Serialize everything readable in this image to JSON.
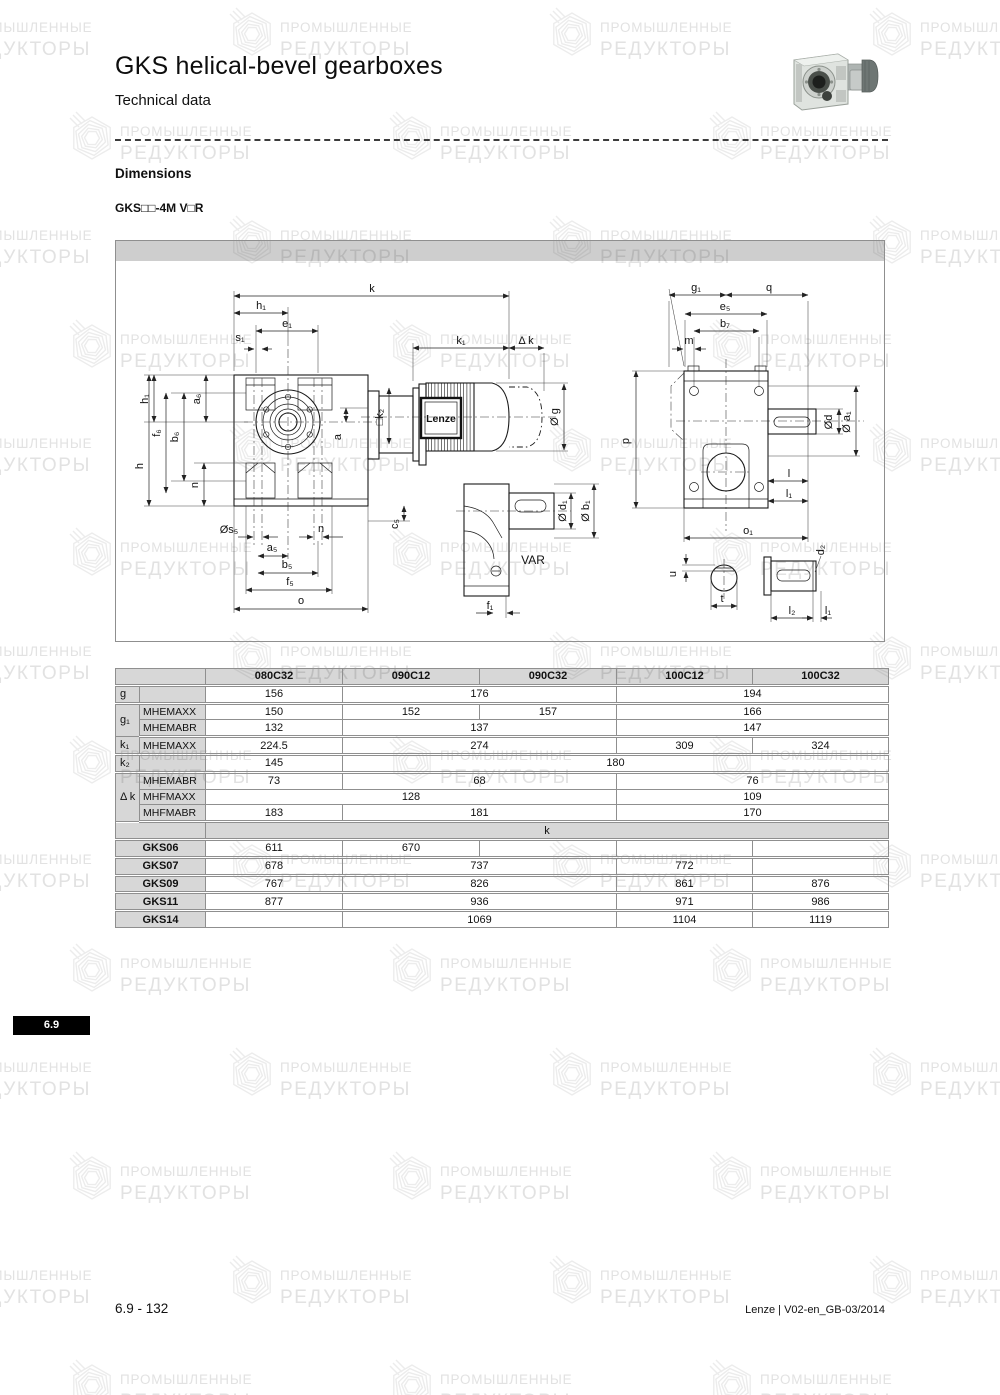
{
  "page": {
    "title": "GKS helical-bevel gearboxes",
    "subtitle": "Technical data",
    "section_heading": "Dimensions",
    "model_code": "GKS□□-4M V□R",
    "side_tab": "6.9",
    "footer_left": "6.9 - 132",
    "footer_right": "Lenze | V02-en_GB-03/2014"
  },
  "watermark": {
    "line1": "ПРОМЫШЛЕННЫЕ",
    "line2": "РЕДУКТОРЫ"
  },
  "colors": {
    "badge_bg": "#000000",
    "table_header_gray": "#d9d9d9",
    "diagram_band_gray": "#c5c5c5",
    "border_gray": "#8f8f8f",
    "watermark_gray": "#e2e2e2"
  },
  "diagram": {
    "labels": [
      {
        "t": "k",
        "x": 256,
        "y": 51
      },
      {
        "t": "h₁",
        "x": 145,
        "y": 68
      },
      {
        "t": "e₁",
        "x": 171,
        "y": 86
      },
      {
        "t": "s₁",
        "x": 124,
        "y": 100
      },
      {
        "t": "k₁",
        "x": 345,
        "y": 103
      },
      {
        "t": "Δ k",
        "x": 410,
        "y": 103
      },
      {
        "t": "□k₂",
        "x": 267,
        "y": 176,
        "r": -90
      },
      {
        "t": "a",
        "x": 225,
        "y": 196,
        "r": -90
      },
      {
        "t": "Ø g",
        "x": 442,
        "y": 176,
        "r": -90
      },
      {
        "t": "h₁",
        "x": 32,
        "y": 158,
        "r": -90
      },
      {
        "t": "a₆",
        "x": 84,
        "y": 158,
        "r": -90
      },
      {
        "t": "f₆",
        "x": 44,
        "y": 192,
        "r": -90
      },
      {
        "t": "b₆",
        "x": 62,
        "y": 196,
        "r": -90
      },
      {
        "t": "h",
        "x": 27,
        "y": 225,
        "r": -90
      },
      {
        "t": "n",
        "x": 82,
        "y": 244,
        "r": -90
      },
      {
        "t": "c₅",
        "x": 282,
        "y": 283,
        "r": -90
      },
      {
        "t": "Øs₅",
        "x": 113,
        "y": 292
      },
      {
        "t": "n",
        "x": 205,
        "y": 291
      },
      {
        "t": "a₅",
        "x": 156,
        "y": 310
      },
      {
        "t": "b₅",
        "x": 171,
        "y": 327
      },
      {
        "t": "f₅",
        "x": 174,
        "y": 344
      },
      {
        "t": "o",
        "x": 185,
        "y": 363
      },
      {
        "t": "Lenze",
        "x": 325,
        "y": 181,
        "cls": "lenze"
      },
      {
        "t": "VAR",
        "x": 417,
        "y": 323,
        "cls": "var"
      },
      {
        "t": "Ø d₁",
        "x": 450,
        "y": 270,
        "r": -90
      },
      {
        "t": "Ø b₁",
        "x": 473,
        "y": 270,
        "r": -90
      },
      {
        "t": "f₁",
        "x": 374,
        "y": 368
      },
      {
        "t": "g₁",
        "x": 580,
        "y": 50
      },
      {
        "t": "q",
        "x": 653,
        "y": 50
      },
      {
        "t": "e₅",
        "x": 609,
        "y": 69
      },
      {
        "t": "b₇",
        "x": 609,
        "y": 86
      },
      {
        "t": "m",
        "x": 573,
        "y": 103
      },
      {
        "t": "p",
        "x": 513,
        "y": 200,
        "r": -90
      },
      {
        "t": "Ød",
        "x": 716,
        "y": 181,
        "r": -90
      },
      {
        "t": "Ø a₁",
        "x": 734,
        "y": 181,
        "r": -90
      },
      {
        "t": "l",
        "x": 673,
        "y": 236
      },
      {
        "t": "l₁",
        "x": 673,
        "y": 256
      },
      {
        "t": "o₁",
        "x": 632,
        "y": 293
      },
      {
        "t": "u",
        "x": 560,
        "y": 333,
        "r": -90
      },
      {
        "t": "t",
        "x": 606,
        "y": 361
      },
      {
        "t": "d₂",
        "x": 708,
        "y": 309,
        "r": -90
      },
      {
        "t": "l₂",
        "x": 676,
        "y": 373
      },
      {
        "t": "l₁",
        "x": 712,
        "y": 373
      }
    ]
  },
  "table": {
    "rows": [
      {
        "sep": true,
        "cells": [
          {
            "t": "",
            "cs": 2,
            "cls": "hdr"
          },
          {
            "t": "080C32",
            "cls": "hdr"
          },
          {
            "t": "090C12",
            "cls": "hdr"
          },
          {
            "t": "090C32",
            "cls": "hdr"
          },
          {
            "t": "100C12",
            "cls": "hdr"
          },
          {
            "t": "100C32",
            "cls": "hdr"
          }
        ]
      },
      {
        "sep": true,
        "cells": [
          {
            "t": "g",
            "cls": "lab"
          },
          {
            "t": "",
            "cls": "sub"
          },
          {
            "t": "156",
            "cls": "val"
          },
          {
            "t": "176",
            "cs": 2,
            "cls": "val"
          },
          {
            "t": "194",
            "cs": 2,
            "cls": "val"
          }
        ]
      },
      {
        "cells": [
          {
            "t": "g₁",
            "rs": 2,
            "cls": "lab"
          },
          {
            "t": "MHEMAXX",
            "cls": "sub"
          },
          {
            "t": "150",
            "cls": "val"
          },
          {
            "t": "152",
            "cls": "val"
          },
          {
            "t": "157",
            "cls": "val"
          },
          {
            "t": "166",
            "cs": 2,
            "cls": "val"
          }
        ]
      },
      {
        "sep": true,
        "cells": [
          {
            "t": "MHEMABR",
            "cls": "sub"
          },
          {
            "t": "132",
            "cls": "val"
          },
          {
            "t": "137",
            "cs": 2,
            "cls": "val"
          },
          {
            "t": "147",
            "cs": 2,
            "cls": "val"
          }
        ]
      },
      {
        "sep": true,
        "cells": [
          {
            "t": "k₁",
            "cls": "lab"
          },
          {
            "t": "MHEMAXX",
            "cls": "sub"
          },
          {
            "t": "224.5",
            "cls": "val"
          },
          {
            "t": "274",
            "cs": 2,
            "cls": "val"
          },
          {
            "t": "309",
            "cls": "val"
          },
          {
            "t": "324",
            "cls": "val"
          }
        ]
      },
      {
        "sep": true,
        "cells": [
          {
            "t": "k₂",
            "cls": "lab"
          },
          {
            "t": "",
            "cls": "sub"
          },
          {
            "t": "145",
            "cls": "val"
          },
          {
            "t": "180",
            "cs": 4,
            "cls": "val"
          }
        ]
      },
      {
        "cells": [
          {
            "t": "Δ k",
            "rs": 3,
            "cls": "lab"
          },
          {
            "t": "MHEMABR",
            "cls": "sub"
          },
          {
            "t": "73",
            "cls": "val"
          },
          {
            "t": "68",
            "cs": 2,
            "cls": "val"
          },
          {
            "t": "76",
            "cs": 2,
            "cls": "val"
          }
        ]
      },
      {
        "cells": [
          {
            "t": "MHFMAXX",
            "cls": "sub"
          },
          {
            "t": "128",
            "cs": 3,
            "cls": "val"
          },
          {
            "t": "109",
            "cs": 2,
            "cls": "val"
          }
        ]
      },
      {
        "sep": true,
        "cells": [
          {
            "t": "MHFMABR",
            "cls": "sub"
          },
          {
            "t": "183",
            "cls": "val"
          },
          {
            "t": "181",
            "cs": 2,
            "cls": "val"
          },
          {
            "t": "170",
            "cs": 2,
            "cls": "val"
          }
        ]
      },
      {
        "sep": true,
        "cells": [
          {
            "t": "",
            "cs": 2,
            "cls": "sh"
          },
          {
            "t": "k",
            "cs": 5,
            "cls": "sh ctr"
          }
        ]
      },
      {
        "sep": true,
        "cells": [
          {
            "t": "GKS06",
            "cs": 2,
            "cls": "gks"
          },
          {
            "t": "611",
            "cls": "val"
          },
          {
            "t": "670",
            "cls": "val"
          },
          {
            "t": "",
            "cls": "val"
          },
          {
            "t": "",
            "cls": "val"
          },
          {
            "t": "",
            "cls": "val"
          }
        ]
      },
      {
        "sep": true,
        "cells": [
          {
            "t": "GKS07",
            "cs": 2,
            "cls": "gks"
          },
          {
            "t": "678",
            "cls": "val"
          },
          {
            "t": "737",
            "cs": 2,
            "cls": "val"
          },
          {
            "t": "772",
            "cls": "val"
          },
          {
            "t": "",
            "cls": "val"
          }
        ]
      },
      {
        "sep": true,
        "cells": [
          {
            "t": "GKS09",
            "cs": 2,
            "cls": "gks"
          },
          {
            "t": "767",
            "cls": "val"
          },
          {
            "t": "826",
            "cs": 2,
            "cls": "val"
          },
          {
            "t": "861",
            "cls": "val"
          },
          {
            "t": "876",
            "cls": "val"
          }
        ]
      },
      {
        "sep": true,
        "cells": [
          {
            "t": "GKS11",
            "cs": 2,
            "cls": "gks"
          },
          {
            "t": "877",
            "cls": "val"
          },
          {
            "t": "936",
            "cs": 2,
            "cls": "val"
          },
          {
            "t": "971",
            "cls": "val"
          },
          {
            "t": "986",
            "cls": "val"
          }
        ]
      },
      {
        "cells": [
          {
            "t": "GKS14",
            "cs": 2,
            "cls": "gks"
          },
          {
            "t": "",
            "cls": "val"
          },
          {
            "t": "1069",
            "cs": 2,
            "cls": "val"
          },
          {
            "t": "1104",
            "cls": "val"
          },
          {
            "t": "1119",
            "cls": "val"
          }
        ]
      }
    ]
  }
}
